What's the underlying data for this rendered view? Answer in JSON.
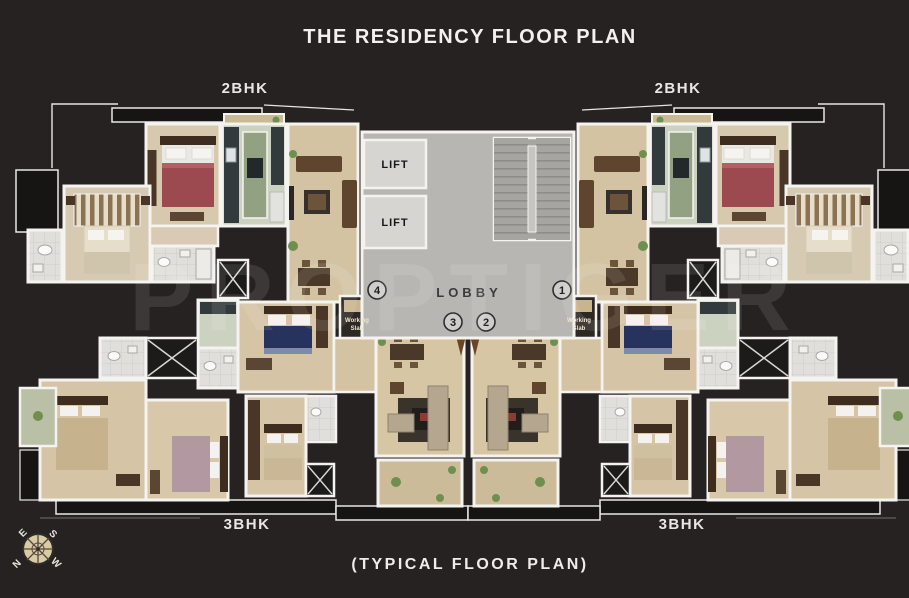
{
  "header": {
    "title": "THE RESIDENCY FLOOR PLAN"
  },
  "footer": {
    "caption": "(TYPICAL FLOOR PLAN)"
  },
  "watermark": "PROPTIGER",
  "unit_labels": {
    "top_left": "2BHK",
    "top_right": "2BHK",
    "bottom_left": "3BHK",
    "bottom_right": "3BHK"
  },
  "core": {
    "lift_top": "LIFT",
    "lift_bottom": "LIFT",
    "lobby": "LOBBY",
    "flat_numbers": {
      "n1": "1",
      "n2": "2",
      "n3": "3",
      "n4": "4"
    }
  },
  "slab_labels": {
    "left": {
      "line1": "Working",
      "line2": "Slab"
    },
    "right": {
      "line1": "Working",
      "line2": "Slab"
    }
  },
  "compass": {
    "n": "N",
    "e": "E",
    "s": "S",
    "w": "W"
  },
  "colors": {
    "background": "#262222",
    "wall": "#f4f3f0",
    "floor_beige": "#d3c3a2",
    "lobby_gray": "#b7b6b2",
    "bathroom_tile": "#e0dfdb",
    "kitchen_green": "#93a183",
    "bed_red": "#9c4a50",
    "bed_navy": "#27335c",
    "bed_mauve": "#b298a0",
    "wood_brown": "#5f452e",
    "plant_green": "#6f8f4f"
  }
}
